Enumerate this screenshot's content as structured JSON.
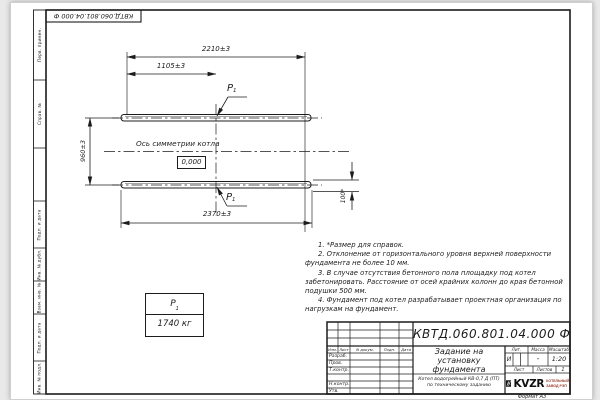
{
  "colors": {
    "line": "#1c1c1c",
    "logo_caption": "#9a3b2e",
    "logo_black": "#111111"
  },
  "frame": {
    "designation_top": "КВТД.060.801.04.000 Ф",
    "format_note": "Формат А3",
    "strip": [
      "Перв. примен.",
      "Справ. №",
      "Подп. и дата",
      "Инв. № дубл.",
      "Взам. инв. №",
      "Подп. и дата",
      "Инв. № подл."
    ]
  },
  "drawing": {
    "dims": {
      "d2210": "2210±3",
      "d1105": "1105±3",
      "d960": "960±3",
      "d2370": "2370±3",
      "d100": "100*"
    },
    "axis_label": "Ось симметрии котла",
    "level_mark": "0,000",
    "load": {
      "p": "P",
      "sub": "1"
    },
    "mass_table": {
      "mass": "1740 кг"
    }
  },
  "notes": [
    "1. *Размер для справок.",
    "2. Отклонение от горизонтального уровня верхней поверхности фундамента не более 10 мм.",
    "3. В случае отсутствия бетонного пола площадку под котел забетонировать. Расстояние от осей крайних колонн до края бетонной подушки 500 мм.",
    "4. Фундамент под котел разрабатывает проектная организация по нагрузкам на фундамент."
  ],
  "title_block": {
    "designation": "КВТД.060.801.04.000 Ф",
    "doc_title": "Задание на установку фундамента",
    "product_line1": "Котел водогрейный КВ-0,7 Д (ПТ)",
    "product_line2": "по техническому заданию",
    "col_izm": "Изм.",
    "col_list": "Лист",
    "col_doc": "N докум.",
    "col_podp": "Подп.",
    "col_data": "Дата",
    "row_razrab": "Разраб.",
    "row_prov": "Пров.",
    "row_tkontr": "Т.контр.",
    "row_nkontr": "Н.контр.",
    "row_utv": "Утв.",
    "lit_header": "Лит.",
    "mass_header": "Масса",
    "scale_header": "Масштаб",
    "lit_value": "И",
    "mass_value": "-",
    "scale_value": "1:20",
    "sheet_label": "Лист",
    "sheets_label": "Листов",
    "sheets_value": "1",
    "logo": {
      "text": "KVZR",
      "caption1": "КОТЕЛЬНЫЙ",
      "caption2": "ЗАВОД РЭП"
    }
  }
}
